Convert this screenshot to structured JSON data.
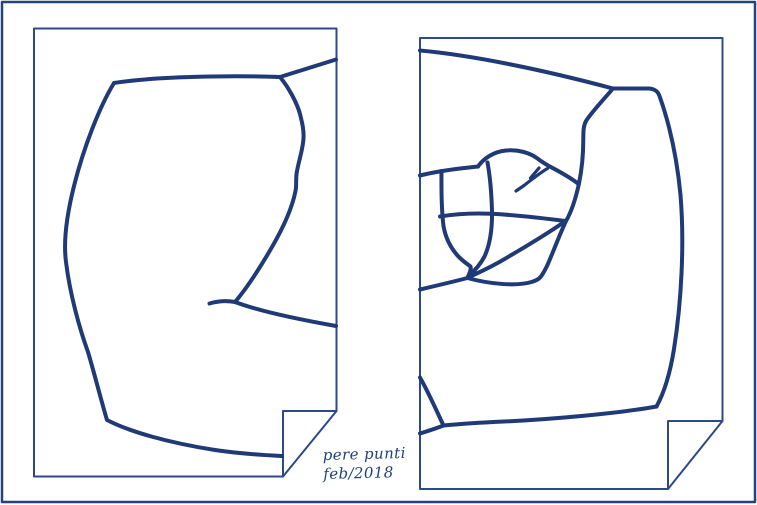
{
  "signature": {
    "line1": "pere punti",
    "line2": "feb/2018"
  },
  "colors": {
    "ink": "#1f3a76",
    "sheet_border": "#2c4a8a",
    "outer_border": "#25427f",
    "paper": "#ffffff",
    "background": "#ffffff",
    "signature_text": "#20407e"
  }
}
